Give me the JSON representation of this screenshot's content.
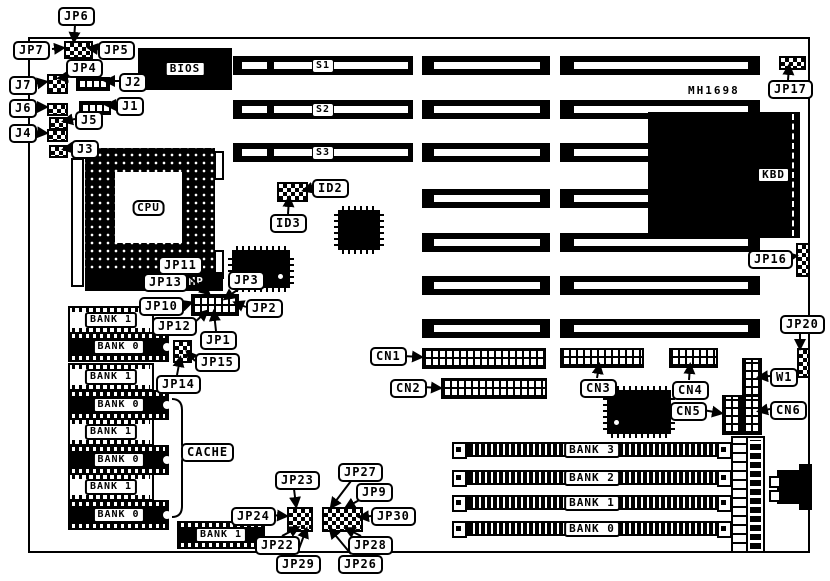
{
  "board": {
    "part_number": "MH1698"
  },
  "chips": {
    "cpu": "CPU",
    "bios": "BIOS",
    "kbd": "KBD",
    "amp": "AMP",
    "cache": "CACHE"
  },
  "slots": {
    "s1": "S1",
    "s2": "S2",
    "s3": "S3"
  },
  "callouts": {
    "jp1": "JP1",
    "jp2": "JP2",
    "jp3": "JP3",
    "jp4": "JP4",
    "jp5": "JP5",
    "jp6": "JP6",
    "jp7": "JP7",
    "jp9": "JP9",
    "jp10": "JP10",
    "jp11": "JP11",
    "jp12": "JP12",
    "jp13": "JP13",
    "jp14": "JP14",
    "jp15": "JP15",
    "jp16": "JP16",
    "jp17": "JP17",
    "jp20": "JP20",
    "jp22": "JP22",
    "jp23": "JP23",
    "jp24": "JP24",
    "jp26": "JP26",
    "jp27": "JP27",
    "jp28": "JP28",
    "jp29": "JP29",
    "jp30": "JP30",
    "j1": "J1",
    "j2": "J2",
    "j3": "J3",
    "j4": "J4",
    "j5": "J5",
    "j6": "J6",
    "j7": "J7",
    "id2": "ID2",
    "id3": "ID3",
    "cn1": "CN1",
    "cn2": "CN2",
    "cn3": "CN3",
    "cn4": "CN4",
    "cn5": "CN5",
    "cn6": "CN6",
    "w1": "W1"
  },
  "cache_chips": [
    "BANK 1",
    "BANK 0",
    "BANK 1",
    "BANK 0",
    "BANK 1",
    "BANK 0",
    "BANK 1",
    "BANK 0"
  ],
  "bottom_chip": "BANK 1",
  "simm_banks": [
    "BANK 3",
    "BANK 2",
    "BANK 1",
    "BANK 0"
  ]
}
